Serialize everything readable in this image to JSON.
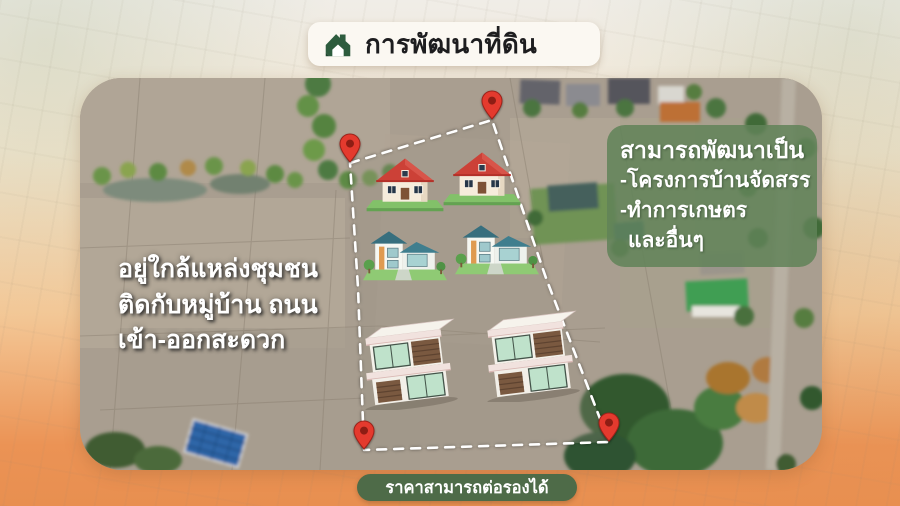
{
  "header": {
    "title": "การพัฒนาที่ดิน",
    "icon": "green-house-logo"
  },
  "captions": {
    "location_lines": [
      "อยู่ใกล้แหล่งชุมชน",
      "ติดกับหมู่บ้าน ถนน",
      "เข้า-ออกสะดวก"
    ]
  },
  "info_box": {
    "title": "สามารถพัฒนาเป็น",
    "items": [
      "-โครงการบ้านจัดสรร",
      "-ทำการเกษตร",
      "และอื่นๆ"
    ]
  },
  "price_badge": "ราคาสามารถต่อรองได้",
  "map": {
    "type": "aerial-photo",
    "boundary": "dashed-white-polygon",
    "pins": [
      "upper-left",
      "top",
      "bottom-right",
      "bottom-left"
    ],
    "illustrations": [
      "red-roof-cottage",
      "red-roof-cottage",
      "teal-roof-house",
      "teal-roof-house",
      "modern-flat-roof-building",
      "modern-flat-roof-building"
    ]
  },
  "colors": {
    "header_icon_green": "#2d5c3e",
    "info_box_green": "#608258",
    "badge_green": "#4e6b48",
    "pin_red": "#e43a2e",
    "frame_orange": "#e8935a",
    "frame_cream": "#f0ede7"
  }
}
